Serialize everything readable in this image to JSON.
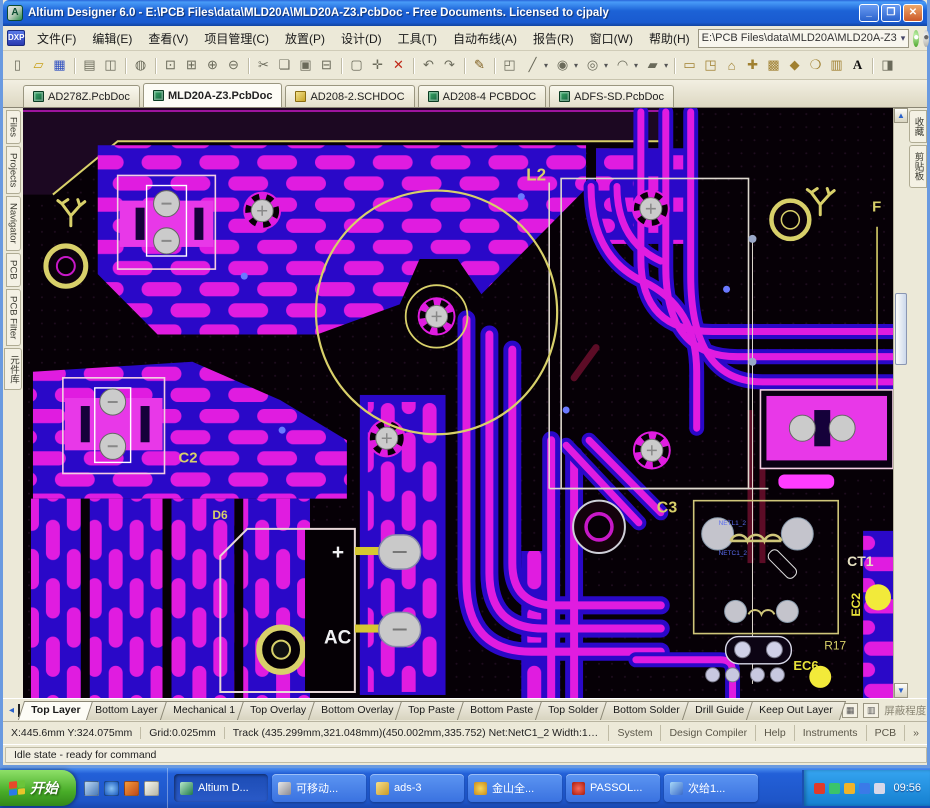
{
  "window": {
    "title": "Altium Designer 6.0 - E:\\PCB Files\\data\\MLD20A\\MLD20A-Z3.PcbDoc - Free Documents. Licensed to cjpaly",
    "app_icon": "A",
    "controls": [
      {
        "name": "minimize-button",
        "glyph": "_"
      },
      {
        "name": "restore-button",
        "glyph": "❐"
      },
      {
        "name": "close-button",
        "glyph": "✕",
        "cls": "close"
      }
    ]
  },
  "menu": {
    "dxp_label": "DXP",
    "items": [
      "文件(F)",
      "编辑(E)",
      "查看(V)",
      "项目管理(C)",
      "放置(P)",
      "设计(D)",
      "工具(T)",
      "自动布线(A)",
      "报告(R)",
      "窗口(W)",
      "帮助(H)"
    ],
    "path_value": "E:\\PCB Files\\data\\MLD20A\\MLD20A-Z3",
    "path_dropdown": "▾",
    "nav_icons": [
      {
        "name": "home-page-icon",
        "glyph": "●",
        "cls": "g"
      },
      {
        "name": "favorites-icon",
        "glyph": "●",
        "cls": "gray"
      },
      {
        "name": "fly-over-icon",
        "glyph": "➤",
        "cls": "g2"
      }
    ]
  },
  "toolbar": {
    "dropdown_arrow": "▾",
    "group1": [
      {
        "name": "new-document-icon",
        "glyph": "▯"
      },
      {
        "name": "open-document-icon",
        "glyph": "▱",
        "cls": "c-folder"
      },
      {
        "name": "save-icon",
        "glyph": "▦",
        "cls": "c-save"
      },
      {
        "name": "print-icon",
        "glyph": "▤",
        "cls": "sep"
      },
      {
        "name": "print-preview-icon",
        "glyph": "◫"
      },
      {
        "name": "browse-documents-icon",
        "glyph": "◍",
        "cls": "sep"
      },
      {
        "name": "zoom-fit-icon",
        "glyph": "⊡",
        "cls": "sep"
      },
      {
        "name": "zoom-area-icon",
        "glyph": "⊞"
      },
      {
        "name": "zoom-in-icon",
        "glyph": "⊕"
      },
      {
        "name": "zoom-out-icon",
        "glyph": "⊖"
      },
      {
        "name": "cut-icon",
        "glyph": "✂",
        "cls": "sep"
      },
      {
        "name": "copy-icon",
        "glyph": "❏"
      },
      {
        "name": "paste-icon",
        "glyph": "▣"
      },
      {
        "name": "paste-special-icon",
        "glyph": "⊟"
      },
      {
        "name": "select-area-icon",
        "glyph": "▢",
        "cls": "sep"
      },
      {
        "name": "move-icon",
        "glyph": "✛"
      },
      {
        "name": "clear-filter-icon",
        "glyph": "✕",
        "cls": "c-red"
      },
      {
        "name": "undo-icon",
        "glyph": "↶",
        "cls": "sep"
      },
      {
        "name": "redo-icon",
        "glyph": "↷"
      },
      {
        "name": "pencil-icon",
        "glyph": "✎",
        "cls": "sep c-pen"
      },
      {
        "name": "board-view-icon",
        "glyph": "◰",
        "cls": "sep"
      }
    ],
    "combos": [
      {
        "name": "interactive-routing-icon",
        "glyph": "╱"
      },
      {
        "name": "place-pad-icon",
        "glyph": "◉"
      },
      {
        "name": "place-via-icon",
        "glyph": "◎"
      },
      {
        "name": "place-arc-icon",
        "glyph": "◠"
      },
      {
        "name": "place-fill-icon",
        "glyph": "▰"
      }
    ],
    "group2": [
      {
        "name": "place-room-icon",
        "glyph": "▭",
        "cls": "sep c-tan"
      },
      {
        "name": "place-component-icon",
        "glyph": "◳",
        "cls": "c-tan"
      },
      {
        "name": "place-polygon-icon",
        "glyph": "⌂",
        "cls": "c-tan"
      },
      {
        "name": "place-coordinate-icon",
        "glyph": "✚",
        "cls": "c-tan"
      },
      {
        "name": "place-array-icon",
        "glyph": "▩",
        "cls": "c-tan"
      },
      {
        "name": "place-keepout-icon",
        "glyph": "◆",
        "cls": "c-tan"
      },
      {
        "name": "place-circle-icon",
        "glyph": "❍",
        "cls": "c-tan"
      },
      {
        "name": "grid-settings-icon",
        "glyph": "▥",
        "cls": "c-tan"
      },
      {
        "name": "place-string-icon",
        "glyph": "A",
        "cls": "c-text"
      },
      {
        "name": "help-pointer-icon",
        "glyph": "◨",
        "cls": "sep"
      }
    ]
  },
  "doc_tabs": [
    {
      "label": "AD278Z.PcbDoc",
      "kind": "pcb"
    },
    {
      "label": "MLD20A-Z3.PcbDoc",
      "kind": "pcb",
      "state": "active"
    },
    {
      "label": "AD208-2.SCHDOC",
      "kind": "sch"
    },
    {
      "label": "AD208-4 PCBDOC",
      "kind": "pcb"
    },
    {
      "label": "ADFS-SD.PcbDoc",
      "kind": "pcb"
    }
  ],
  "left_tabs": [
    "Files",
    "Projects",
    "Navigator",
    "PCB",
    "PCB Filter",
    "元件库"
  ],
  "right_tabs": [
    "收藏",
    "剪贴板"
  ],
  "scrollbar": {
    "up": "▲",
    "down": "▼"
  },
  "pcb": {
    "labels": {
      "inductor": "L2",
      "cap2": "C2",
      "cap3": "C3",
      "transformer": "CT1",
      "diode": "D6",
      "plus": "+",
      "ac": "AC",
      "ec2": "EC2",
      "ec6": "EC6",
      "r17": "R17",
      "fuse": "F"
    },
    "net_labels": [
      "NETL1_2",
      "NETC1_2"
    ],
    "colors": {
      "pour": "#e01ce0",
      "trace_blue": "#2a08c8",
      "silkscreen": "#d8d06a",
      "pad": "#c9c9c9",
      "background": "#060006"
    }
  },
  "layer_bar": {
    "left_arrow": "◂",
    "tabs": [
      {
        "label": "Top Layer",
        "state": "active"
      },
      {
        "label": "Bottom Layer"
      },
      {
        "label": "Mechanical 1"
      },
      {
        "label": "Top Overlay"
      },
      {
        "label": "Bottom Overlay"
      },
      {
        "label": "Top Paste"
      },
      {
        "label": "Bottom Paste"
      },
      {
        "label": "Top Solder"
      },
      {
        "label": "Bottom Solder"
      },
      {
        "label": "Drill Guide"
      },
      {
        "label": "Keep Out Layer"
      }
    ],
    "btn1": "▦",
    "btn2": "▥",
    "mask_label": "屏蔽程度",
    "clear_label": "清除"
  },
  "status": {
    "coords": "X:445.6mm Y:324.075mm",
    "grid": "Grid:0.025mm",
    "track": "Track (435.299mm,321.048mm)(450.002mm,335.752) Net:NetC1_2 Width:1.5mm Length:3",
    "panels": [
      "System",
      "Design Compiler",
      "Help",
      "Instruments",
      "PCB",
      "»"
    ],
    "idle": "Idle state - ready for command"
  },
  "taskbar": {
    "start": "开始",
    "quick": [
      {
        "name": "quick-launch-desktop-icon",
        "icon": "ic-desk"
      },
      {
        "name": "quick-launch-ie-icon",
        "icon": "ic-ie"
      },
      {
        "name": "quick-launch-media-icon",
        "icon": "ic-media"
      },
      {
        "name": "quick-launch-doc-icon",
        "icon": "ic-doc"
      }
    ],
    "buttons": [
      {
        "label": "Altium D...",
        "icon": "ic-altium",
        "state": "active",
        "name": "task-button-altium"
      },
      {
        "label": "可移动...",
        "icon": "ic-disk",
        "name": "task-button-removable-disk"
      },
      {
        "label": "ads-3",
        "icon": "ic-folder",
        "name": "task-button-ads3-folder"
      },
      {
        "label": "金山全...",
        "icon": "ic-gold",
        "name": "task-button-kingsoft"
      },
      {
        "label": "PASSOL...",
        "icon": "ic-passol",
        "name": "task-button-passol"
      },
      {
        "label": "次给1...",
        "icon": "ic-chat",
        "name": "task-button-chat"
      }
    ],
    "tray": [
      {
        "name": "tray-antivirus-icon",
        "icon": "ic-t1"
      },
      {
        "name": "tray-messenger-icon",
        "icon": "ic-t2"
      },
      {
        "name": "tray-update-icon",
        "icon": "ic-t3"
      },
      {
        "name": "tray-network-icon",
        "icon": "ic-t4"
      },
      {
        "name": "tray-volume-icon",
        "icon": "ic-t5"
      }
    ],
    "clock": "09:56"
  }
}
